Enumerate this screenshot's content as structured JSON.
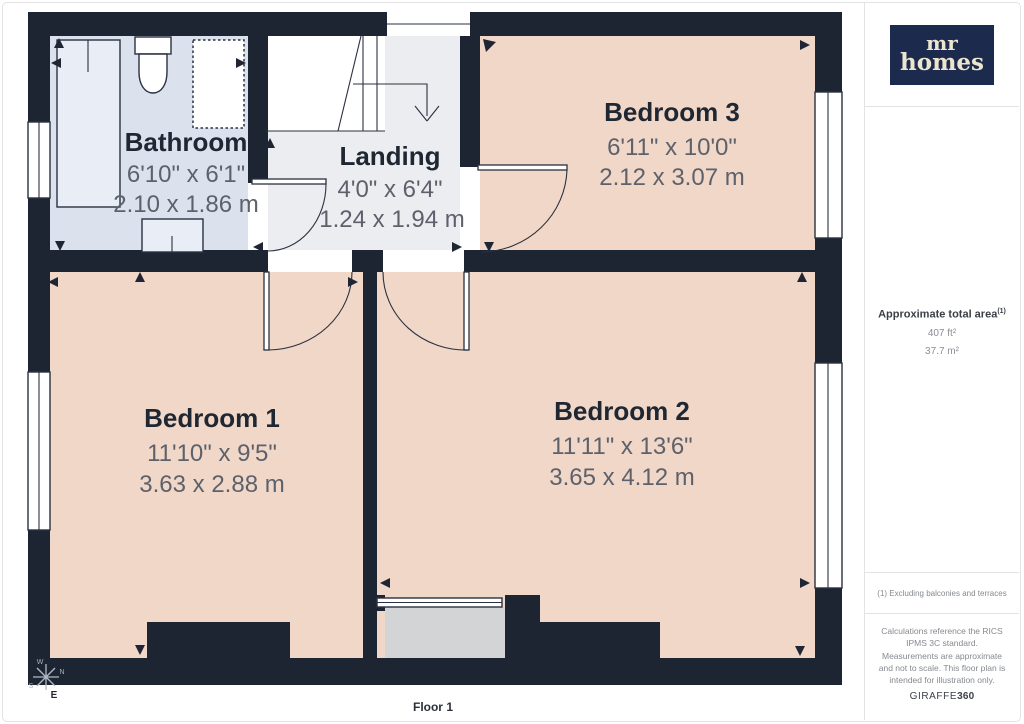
{
  "page": {
    "floor_label": "Floor 1"
  },
  "rooms": {
    "bathroom": {
      "name": "Bathroom",
      "dim_imperial": "6'10\" x 6'1\"",
      "dim_metric": "2.10 x 1.86 m"
    },
    "landing": {
      "name": "Landing",
      "dim_imperial": "4'0\" x 6'4\"",
      "dim_metric": "1.24 x 1.94 m"
    },
    "bedroom3": {
      "name": "Bedroom 3",
      "dim_imperial": "6'11\" x 10'0\"",
      "dim_metric": "2.12 x 3.07 m"
    },
    "bedroom1": {
      "name": "Bedroom 1",
      "dim_imperial": "11'10\" x 9'5\"",
      "dim_metric": "3.63 x 2.88 m"
    },
    "bedroom2": {
      "name": "Bedroom 2",
      "dim_imperial": "11'11\" x 13'6\"",
      "dim_metric": "3.65 x 4.12 m"
    }
  },
  "compass": {
    "n": "N",
    "e": "E",
    "s": "S",
    "w": "W"
  },
  "sidebar": {
    "logo_line1": "mr",
    "logo_line2": "homes",
    "area_title": "Approximate total area",
    "area_note_ref": "(1)",
    "area_ft": "407 ft²",
    "area_m": "37.7 m²",
    "footnote": "(1) Excluding balconies and terraces",
    "disclaimer": "Calculations reference the RICS IPMS 3C standard. Measurements are approximate and not to scale. This floor plan is intended for illustration only.",
    "brand_name": "GIRAFFE",
    "brand_suffix": "360"
  },
  "colors": {
    "wall": "#1d2533",
    "bedroom_fill": "#f1d7c7",
    "bathroom_fill": "#dce1ee",
    "landing_fill": "#ecedf1",
    "dormer_fill": "#d3d4d6",
    "logo_background": "#1c2b4d",
    "logo_text": "#ece5cf",
    "dimension_text": "#5d616b",
    "room_name_text": "#1f2733"
  }
}
